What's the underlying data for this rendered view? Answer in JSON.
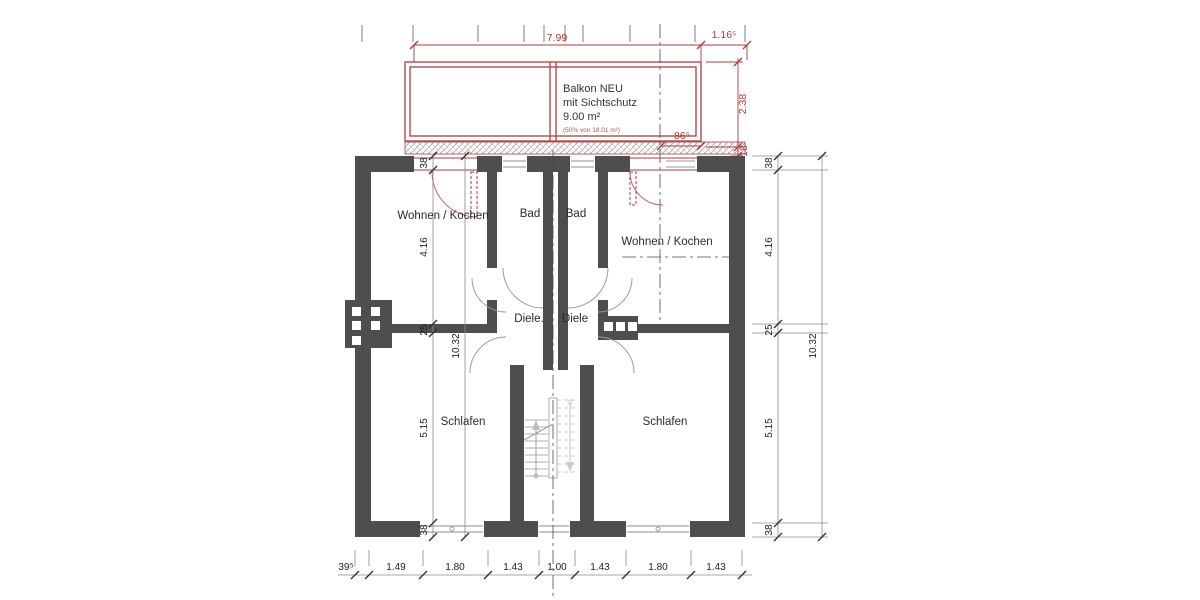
{
  "rooms": {
    "living_left": "Wohnen / Kochen",
    "bath_left": "Bad",
    "bath_right": "Bad",
    "living_right": "Wohnen / Kochen",
    "hall_left": "Diele.",
    "hall_right": "Diele",
    "bedroom_left": "Schlafen",
    "bedroom_right": "Schlafen"
  },
  "balcony": {
    "title": "Balkon NEU",
    "subtitle": "mit Sichtschutz",
    "area": "9.00 m²",
    "note": "(50% von 18.01 m²)"
  },
  "dims": {
    "top_width": "7.99",
    "top_side": "1.16⁵",
    "balcony_depth": "2.38",
    "balcony_slab": "18",
    "door_offset": "86⁵",
    "left_chain": [
      "38",
      "4.16",
      "25",
      "5.15",
      "38"
    ],
    "left_total": "10.32",
    "right_chain": [
      "38",
      "4.16",
      "25",
      "5.15",
      "38"
    ],
    "right_total": "10.32",
    "bottom": [
      "39⁵",
      "1.49",
      "1.80",
      "1.43",
      "1.00",
      "1.43",
      "1.80",
      "1.43"
    ]
  },
  "colors": {
    "wall": "#4e4e4e",
    "red": "#ab3c3c",
    "dimline": "#8a8a8a",
    "stairs": "#b9b9b9"
  }
}
